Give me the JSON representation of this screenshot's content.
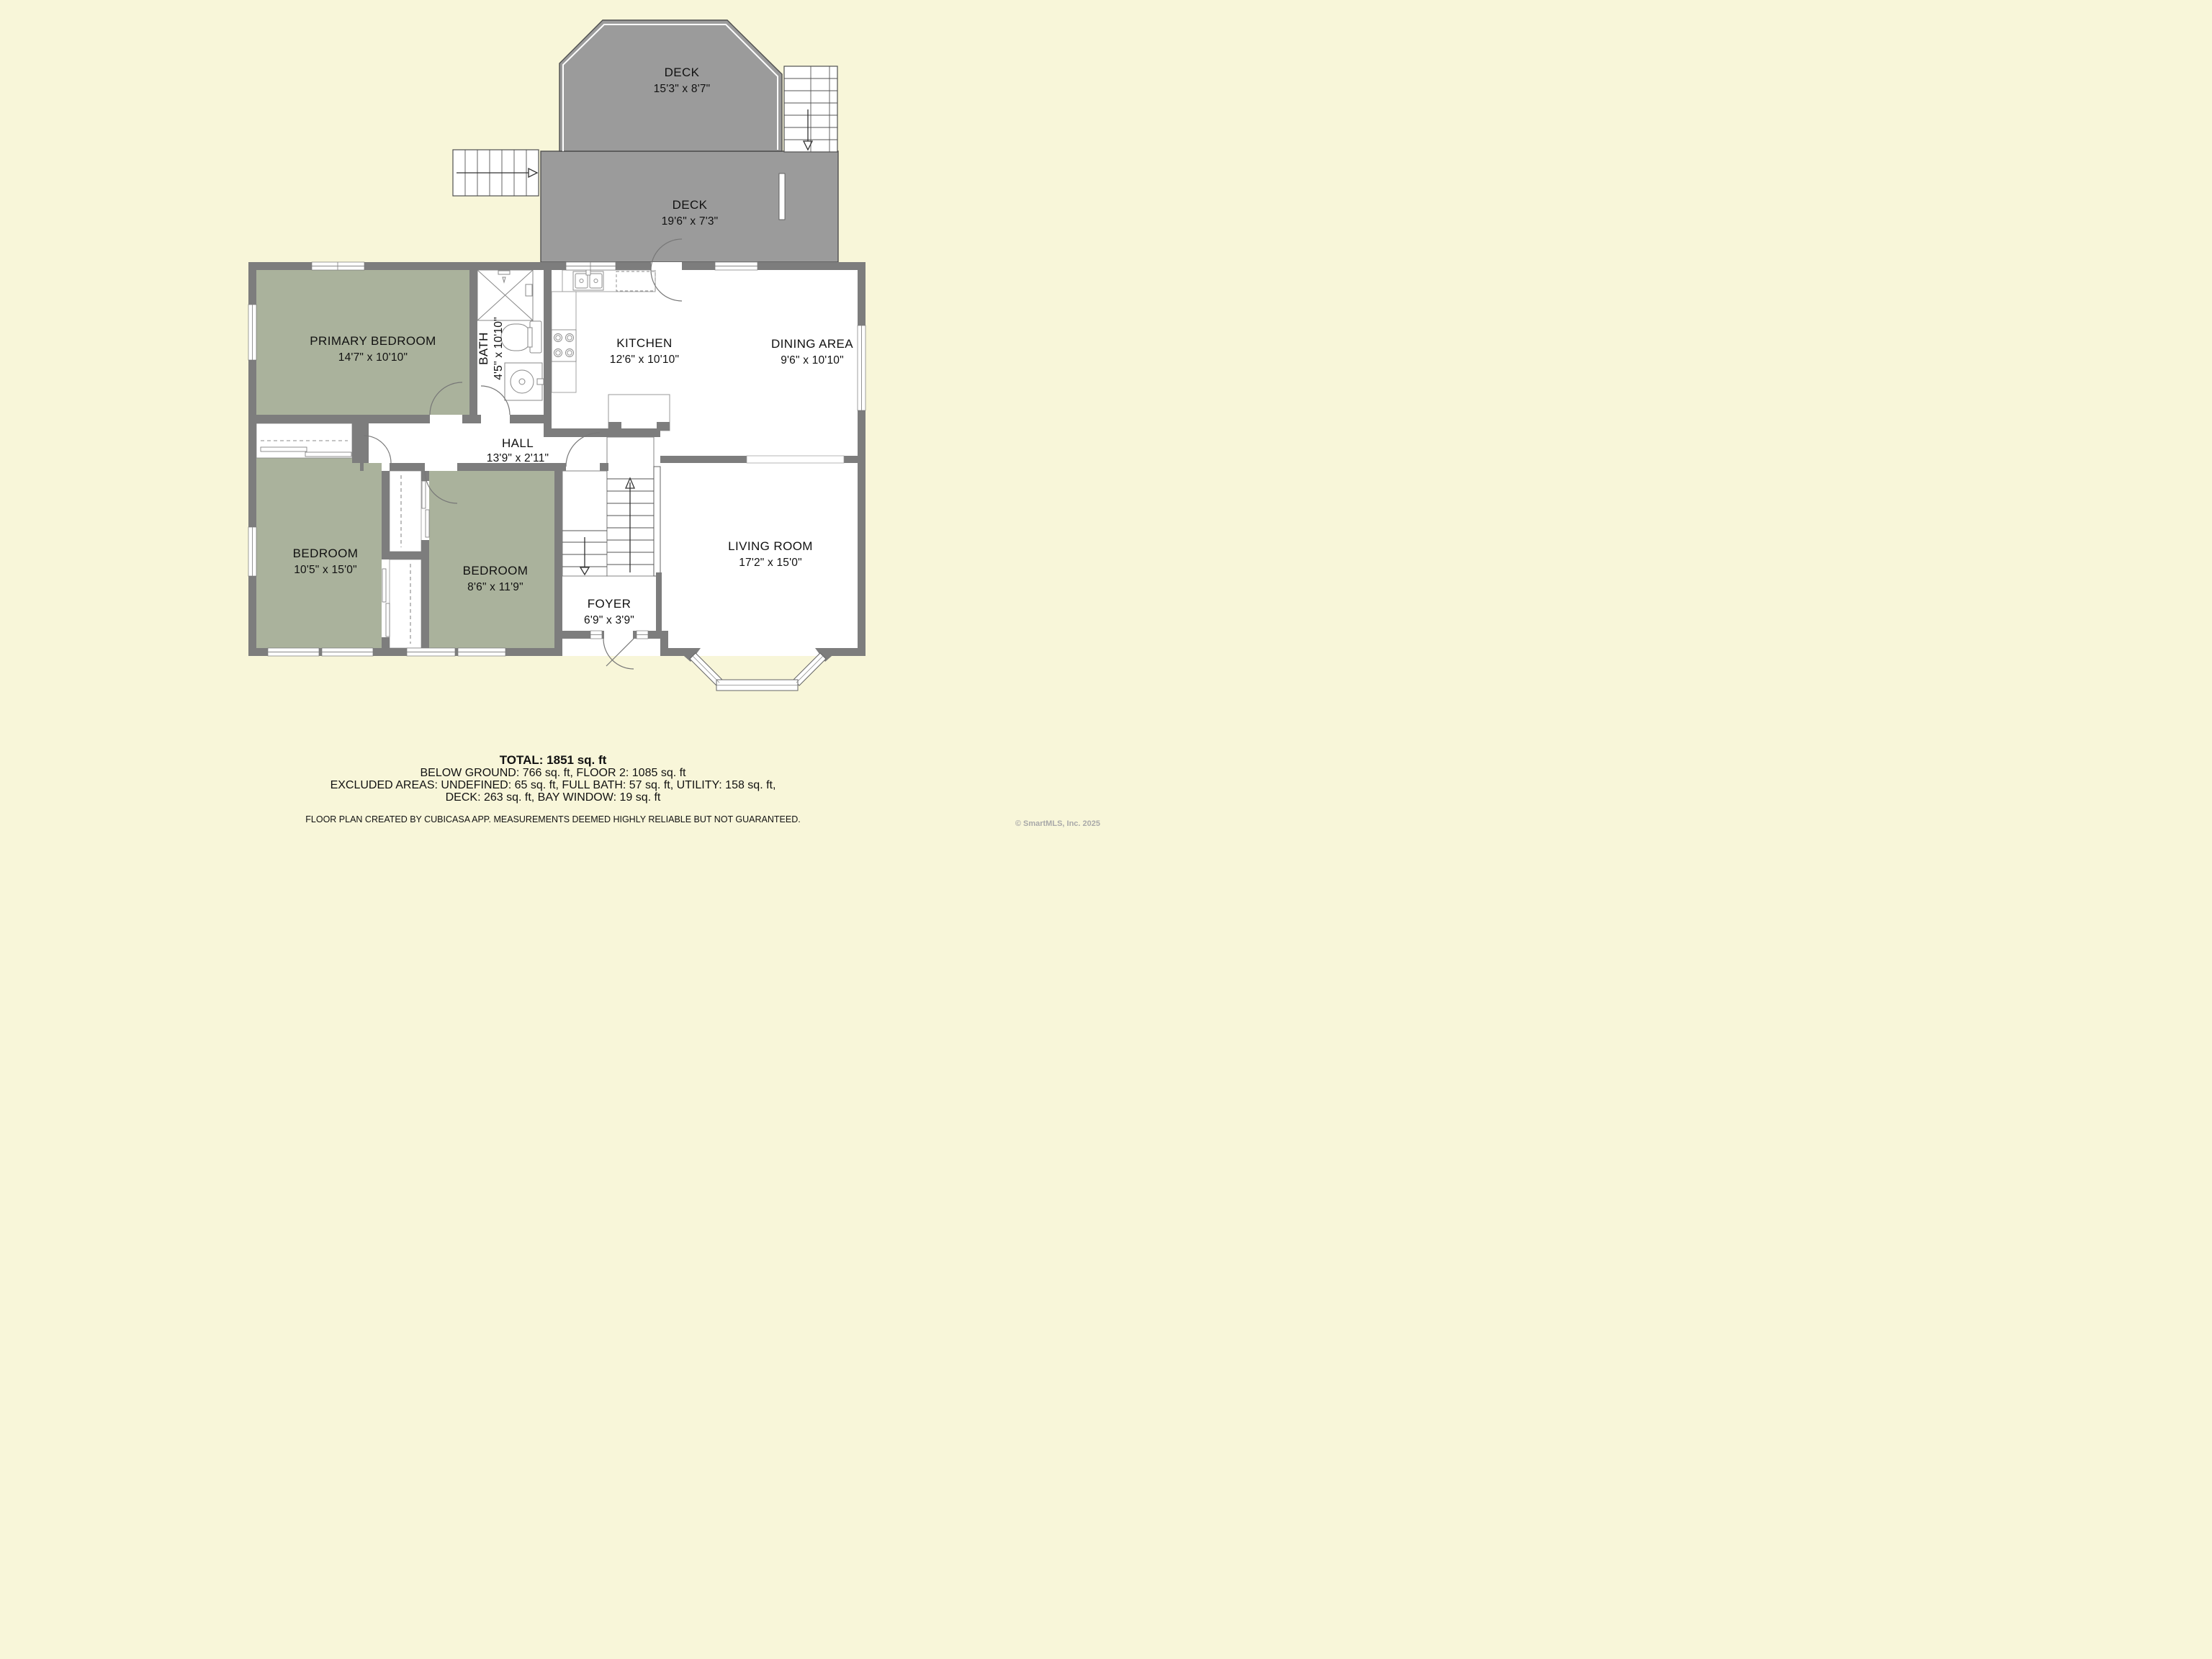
{
  "decks": {
    "upper": {
      "name": "DECK",
      "dims": "15'3\" x 8'7\""
    },
    "lower": {
      "name": "DECK",
      "dims": "19'6\" x 7'3\""
    }
  },
  "rooms": {
    "primary_bedroom": {
      "name": "PRIMARY BEDROOM",
      "dims": "14'7\" x 10'10\""
    },
    "bath": {
      "name": "BATH",
      "dims": "4'5\" x 10'10\""
    },
    "kitchen": {
      "name": "KITCHEN",
      "dims": "12'6\" x 10'10\""
    },
    "dining_area": {
      "name": "DINING AREA",
      "dims": "9'6\" x 10'10\""
    },
    "hall": {
      "name": "HALL",
      "dims": "13'9\" x 2'11\""
    },
    "bedroom_left": {
      "name": "BEDROOM",
      "dims": "10'5\" x 15'0\""
    },
    "bedroom_middle": {
      "name": "BEDROOM",
      "dims": "8'6\" x 11'9\""
    },
    "foyer": {
      "name": "FOYER",
      "dims": "6'9\" x 3'9\""
    },
    "living_room": {
      "name": "LIVING ROOM",
      "dims": "17'2\" x 15'0\""
    }
  },
  "summary": {
    "total": "TOTAL: 1851 sq. ft",
    "line2": "BELOW GROUND: 766 sq. ft, FLOOR 2: 1085 sq. ft",
    "line3": "EXCLUDED AREAS: UNDEFINED: 65 sq. ft, FULL BATH: 57 sq. ft, UTILITY: 158 sq. ft,",
    "line4": "DECK: 263 sq. ft, BAY WINDOW: 19 sq. ft",
    "disclaimer": "FLOOR PLAN CREATED BY CUBICASA APP. MEASUREMENTS DEEMED HIGHLY RELIABLE BUT NOT GUARANTEED."
  },
  "footer": {
    "copyright": "© SmartMLS, Inc.  2025"
  },
  "colors": {
    "background": "#f8f6d9",
    "deck": "#9b9b9b",
    "wall": "#7d7d7d",
    "bedroom_fill": "#aab29c",
    "floor_fill": "#ffffff"
  }
}
